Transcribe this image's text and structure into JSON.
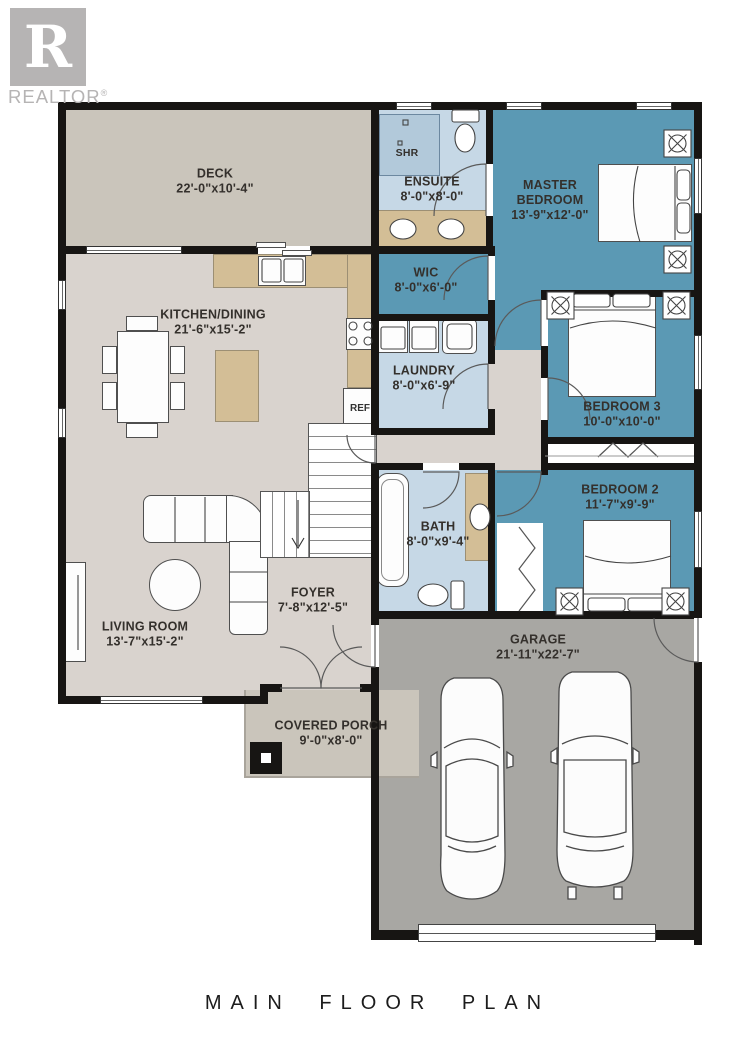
{
  "brand": {
    "logo_letter": "R",
    "logo_text": "REALTOR",
    "registered_mark": "®"
  },
  "title": "MAIN FLOOR PLAN",
  "rooms": {
    "deck": {
      "name": "DECK",
      "dims": "22'-0\"x10'-4\""
    },
    "ensuite": {
      "name": "ENSUITE",
      "dims": "8'-0\"x8'-0\""
    },
    "master_bedroom": {
      "name": "MASTER BEDROOM",
      "dims": "13'-9\"x12'-0\""
    },
    "wic": {
      "name": "WIC",
      "dims": "8'-0\"x6'-0\""
    },
    "kitchen_dining": {
      "name": "KITCHEN/DINING",
      "dims": "21'-6\"x15'-2\""
    },
    "laundry": {
      "name": "LAUNDRY",
      "dims": "8'-0\"x6'-9\""
    },
    "bedroom3": {
      "name": "BEDROOM 3",
      "dims": "10'-0\"x10'-0\""
    },
    "bedroom2": {
      "name": "BEDROOM 2",
      "dims": "11'-7\"x9'-9\""
    },
    "bath": {
      "name": "BATH",
      "dims": "8'-0\"x9'-4\""
    },
    "living_room": {
      "name": "LIVING ROOM",
      "dims": "13'-7\"x15'-2\""
    },
    "foyer": {
      "name": "FOYER",
      "dims": "7'-8\"x12'-5\""
    },
    "garage": {
      "name": "GARAGE",
      "dims": "21'-11\"x22'-7\""
    },
    "covered_porch": {
      "name": "COVERED PORCH",
      "dims": "9'-0\"x8'-0\""
    }
  },
  "fixtures": {
    "shower": "SHR",
    "refrigerator": "REF"
  },
  "colors": {
    "bedroom_teal": "#5b99b4",
    "bath_blue": "#c6d8e6",
    "shower_blue": "#b2c9da",
    "floor_gray": "#d9d3ce",
    "deck_gray": "#cac5bb",
    "garage_gray": "#a8a7a3",
    "counter_tan": "#d3be96",
    "wall_black": "#171513",
    "label_gray": "#34302c",
    "logo_gray": "#b6b4b4"
  }
}
